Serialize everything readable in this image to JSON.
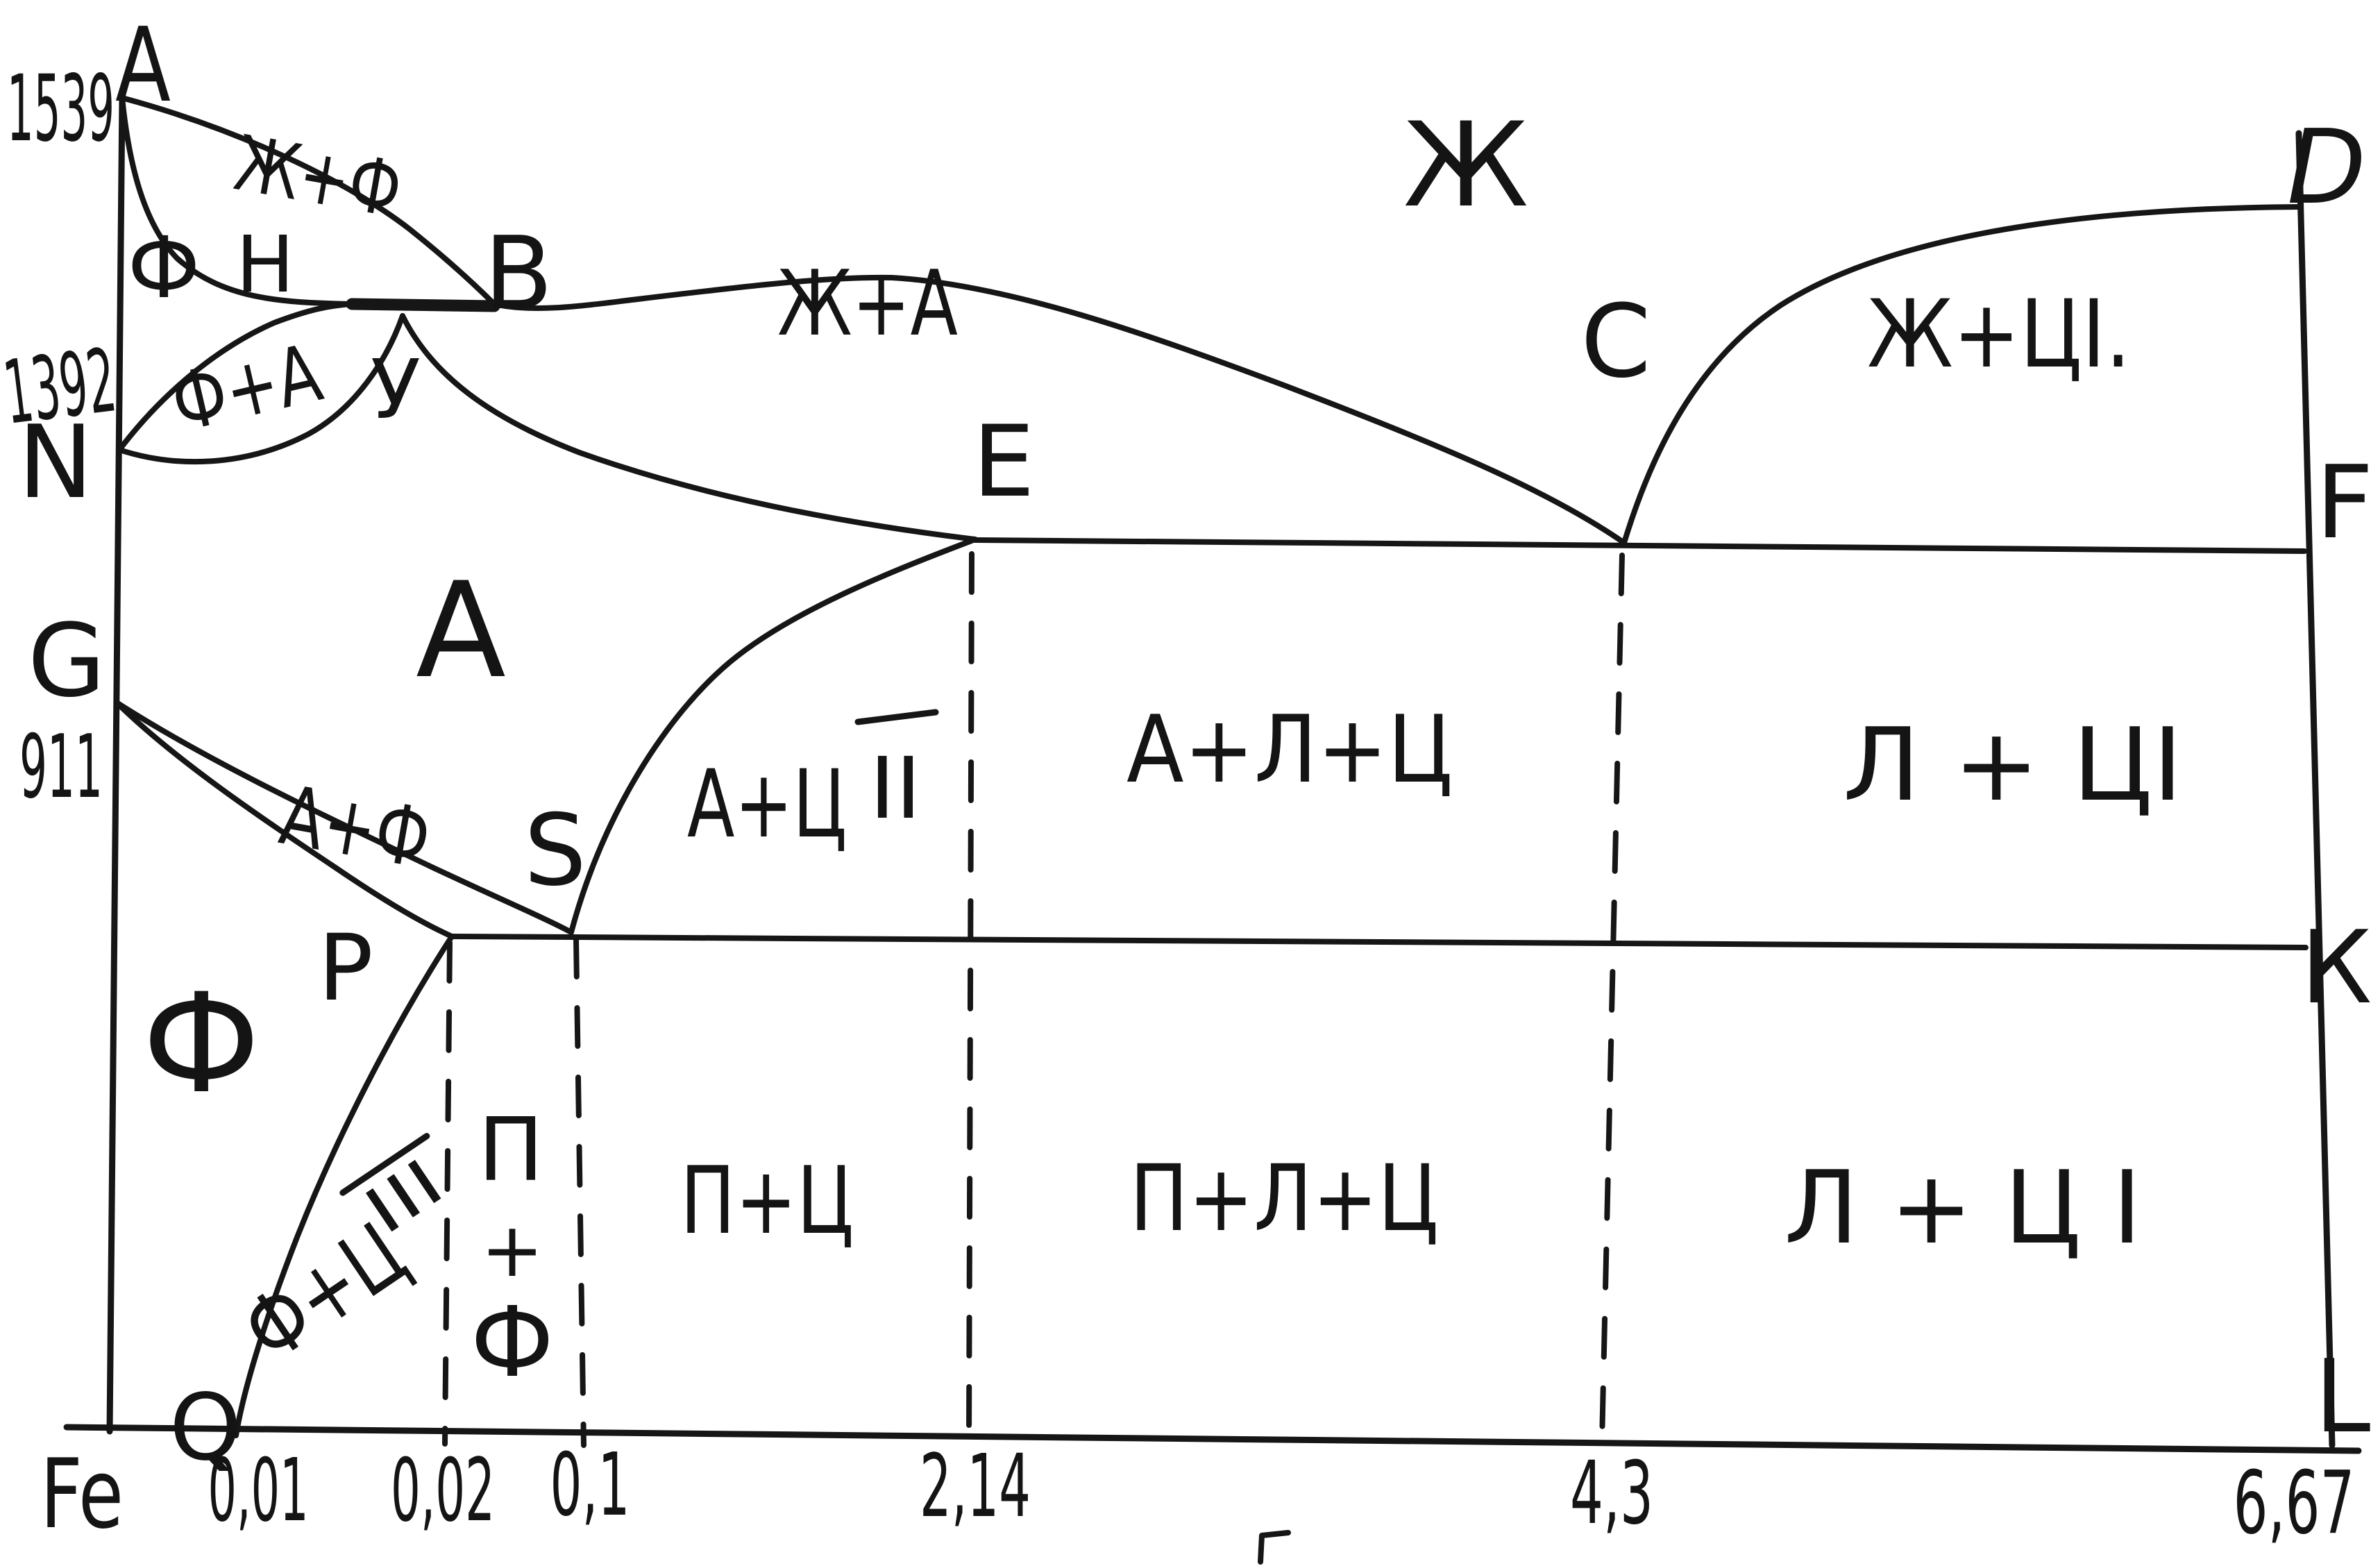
{
  "labels": {
    "t1539": "1539",
    "t1392": "1392",
    "t911": "911",
    "pA": "А",
    "pB": "B",
    "pC": "C",
    "pD": "D",
    "pE": "E",
    "pF": "F",
    "pG": "G",
    "pH": "H",
    "pK": "К",
    "pL": "L",
    "pN": "N",
    "pP": "P",
    "pQ": "Q",
    "pS": "S",
    "pU": "У",
    "rZh": "Ж",
    "rZhF": "Ж+Ф",
    "rFdelta": "Ф",
    "rFA": "Ф+А",
    "rZhA": "Ж+А",
    "rZhC1": "Ж+ЦI.",
    "rA": "А",
    "rAF": "А+Ф",
    "rF": "Ф",
    "rAC2base": "А+Ц",
    "rAC2sup": "II",
    "rALC": "А+Л+Ц",
    "rLC1mid": "Л + ЦI",
    "rFC3base": "Ф+Ц",
    "rFC3sup": "III",
    "rPFtop": "П",
    "rPFplus": "+",
    "rPFbot": "Ф",
    "rPC": "П+Ц",
    "rPLC": "П+Л+Ц",
    "rLC1bot": "Л + Ц I",
    "xFe": "Fe",
    "x001": "0,01",
    "x002": "0,02",
    "x01": "0,1",
    "x214": "2,14",
    "x43": "4,3",
    "x667": "6,67"
  },
  "chart_data": {
    "type": "line",
    "title": "",
    "xlabel": "",
    "ylabel": "",
    "x_tick_labels": [
      "Fe",
      "0,01",
      "0,02",
      "0,1",
      "2,14",
      "4,3",
      "6,67"
    ],
    "y_tick_labels": [
      "1539",
      "1392",
      "911"
    ],
    "key_points": [
      {
        "name": "A",
        "c_percent": 0,
        "t_c": 1539
      },
      {
        "name": "N",
        "c_percent": 0,
        "t_c": 1392
      },
      {
        "name": "G",
        "c_percent": 0,
        "t_c": 911
      },
      {
        "name": "Q",
        "c_percent": 0.01,
        "t_c": null
      },
      {
        "name": "P",
        "c_percent": 0.02,
        "t_c": null
      },
      {
        "name": "S",
        "c_percent": 0.1,
        "t_c": null
      },
      {
        "name": "E",
        "c_percent": 2.14,
        "t_c": null
      },
      {
        "name": "C",
        "c_percent": 4.3,
        "t_c": null
      },
      {
        "name": "D",
        "c_percent": 6.67,
        "t_c": null
      },
      {
        "name": "F",
        "c_percent": 6.67,
        "t_c": null
      },
      {
        "name": "K",
        "c_percent": 6.67,
        "t_c": null
      },
      {
        "name": "L",
        "c_percent": 6.67,
        "t_c": null
      },
      {
        "name": "B",
        "c_percent": null,
        "t_c": null
      },
      {
        "name": "H",
        "c_percent": null,
        "t_c": null
      },
      {
        "name": "У",
        "c_percent": null,
        "t_c": null
      }
    ],
    "regions": [
      "Ж",
      "Ж+Ф",
      "Ф",
      "Ф+А",
      "Ж+А",
      "Ж+ЦI",
      "А",
      "А+Ф",
      "А+ЦII",
      "А+Л+Ц",
      "Л+ЦI",
      "Ф",
      "Ф+ЦIII",
      "П+Ф",
      "П+Ц",
      "П+Л+Ц",
      "Л+ЦI"
    ],
    "boundaries": [
      [
        "A",
        "B"
      ],
      [
        "B",
        "C"
      ],
      [
        "C",
        "D"
      ],
      [
        "A",
        "H"
      ],
      [
        "H",
        "B"
      ],
      [
        "N",
        "H"
      ],
      [
        "N",
        "У"
      ],
      [
        "У",
        "B"
      ],
      [
        "У",
        "E"
      ],
      [
        "E",
        "C",
        "F"
      ],
      [
        "G",
        "S"
      ],
      [
        "G",
        "P"
      ],
      [
        "P",
        "S",
        "K"
      ],
      [
        "P",
        "Q"
      ]
    ],
    "dashed_verticals_at": [
      0.02,
      0.1,
      2.14,
      4.3
    ],
    "grid": false,
    "legend": null
  }
}
